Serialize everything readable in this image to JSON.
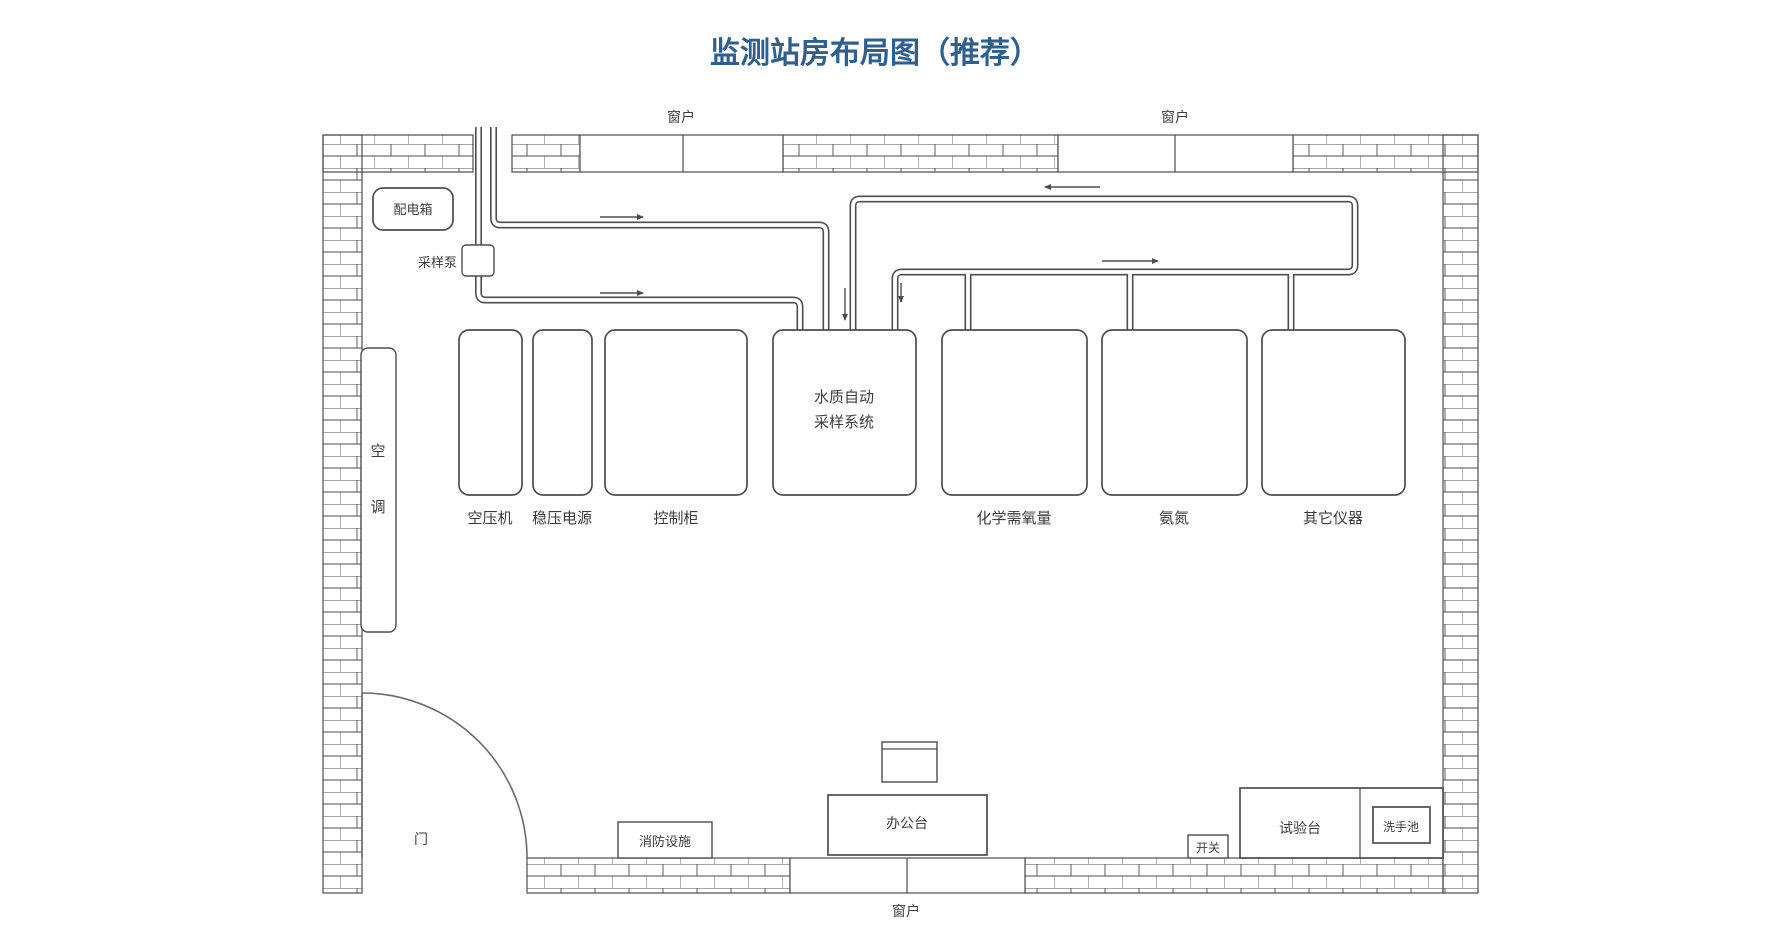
{
  "title": "监测站房布局图（推荐）",
  "colors": {
    "line": "#4d4d4d",
    "title": "#2e5f8e",
    "label": "#3d3d3d"
  },
  "labels": {
    "window": "窗户",
    "distribution_box": "配电箱",
    "sampling_pump": "采样泵",
    "air_conditioner": "空调",
    "air_compressor": "空压机",
    "voltage_stabilizer": "稳压电源",
    "control_cabinet": "控制柜",
    "water_sampler_line1": "水质自动",
    "water_sampler_line2": "采样系统",
    "cod_analyzer": "化学需氧量",
    "ammonia_nitrogen": "氨氮",
    "other_instruments": "其它仪器",
    "door": "门",
    "fire_equipment": "消防设施",
    "office_desk": "办公台",
    "switch": "开关",
    "test_bench": "试验台",
    "sink": "洗手池"
  }
}
